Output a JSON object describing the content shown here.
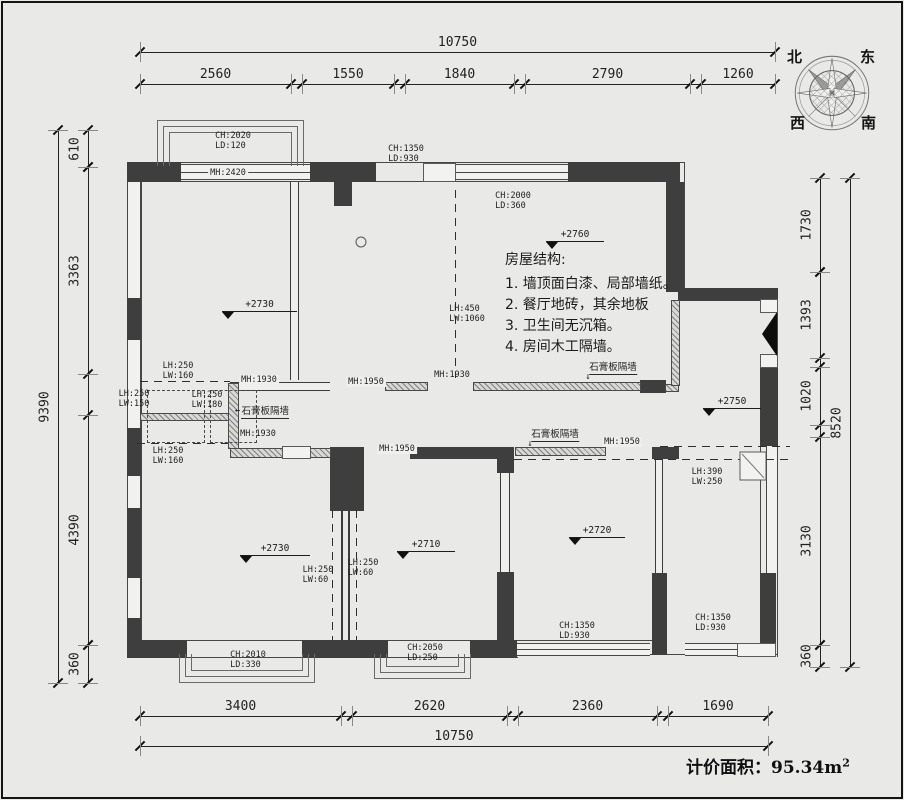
{
  "compass": {
    "north": "北",
    "east": "东",
    "west": "西",
    "south": "南"
  },
  "dimensions": {
    "top_total": "10750",
    "top_segments": [
      "2560",
      "1550",
      "1840",
      "2790",
      "1260"
    ],
    "bottom_segments": [
      "3400",
      "2620",
      "2360",
      "1690"
    ],
    "bottom_total": "10750",
    "left_total": "9390",
    "left_segments": [
      "610",
      "3363",
      "4390",
      "360"
    ],
    "right_segments": [
      "1730",
      "1393",
      "1020",
      "3130",
      "360"
    ],
    "right_total": "8520"
  },
  "levels": [
    "+2730",
    "+2760",
    "+2750",
    "+2730",
    "+2710",
    "+2720"
  ],
  "wall_labels": [
    {
      "lines": [
        "CH:2020",
        "LD:120"
      ]
    },
    {
      "lines": [
        "MH:2420"
      ]
    },
    {
      "lines": [
        "CH:1350",
        "LD:930"
      ]
    },
    {
      "lines": [
        "CH:2000",
        "LD:360"
      ]
    },
    {
      "lines": [
        "LH:450",
        "LW:1060"
      ]
    },
    {
      "lines": [
        "LH:250",
        "LW:160"
      ]
    },
    {
      "lines": [
        "MH:1930"
      ]
    },
    {
      "lines": [
        "LH:250",
        "LW:150"
      ]
    },
    {
      "lines": [
        "LH:250",
        "LW:180"
      ]
    },
    {
      "lines": [
        "石膏板隔墙"
      ]
    },
    {
      "lines": [
        "MH:1930"
      ]
    },
    {
      "lines": [
        "LH:250",
        "LW:160"
      ]
    },
    {
      "lines": [
        "MH:1950"
      ]
    },
    {
      "lines": [
        "MH:1930"
      ]
    },
    {
      "lines": [
        "石膏板隔墙"
      ]
    },
    {
      "lines": [
        "MH:1950"
      ]
    },
    {
      "lines": [
        "石膏板隔墙"
      ]
    },
    {
      "lines": [
        "MH:1950"
      ]
    },
    {
      "lines": [
        "LH:390",
        "LW:250"
      ]
    },
    {
      "lines": [
        "LH:250",
        "LW:60"
      ]
    },
    {
      "lines": [
        "LH:250",
        "LW:60"
      ]
    },
    {
      "lines": [
        "CH:2010",
        "LD:330"
      ]
    },
    {
      "lines": [
        "CH:2050",
        "LD:250"
      ]
    },
    {
      "lines": [
        "CH:1350",
        "LD:930"
      ]
    },
    {
      "lines": [
        "CH:1350",
        "LD:930"
      ]
    }
  ],
  "notes": {
    "heading": "房屋结构:",
    "items": [
      "1. 墙顶面白漆、局部墙纸。",
      "2. 餐厅地砖，其余地板",
      "3. 卫生间无沉箱。",
      "4. 房间木工隔墙。"
    ]
  },
  "area": {
    "label": "计价面积：",
    "value": "95.34m",
    "sup": "2"
  }
}
